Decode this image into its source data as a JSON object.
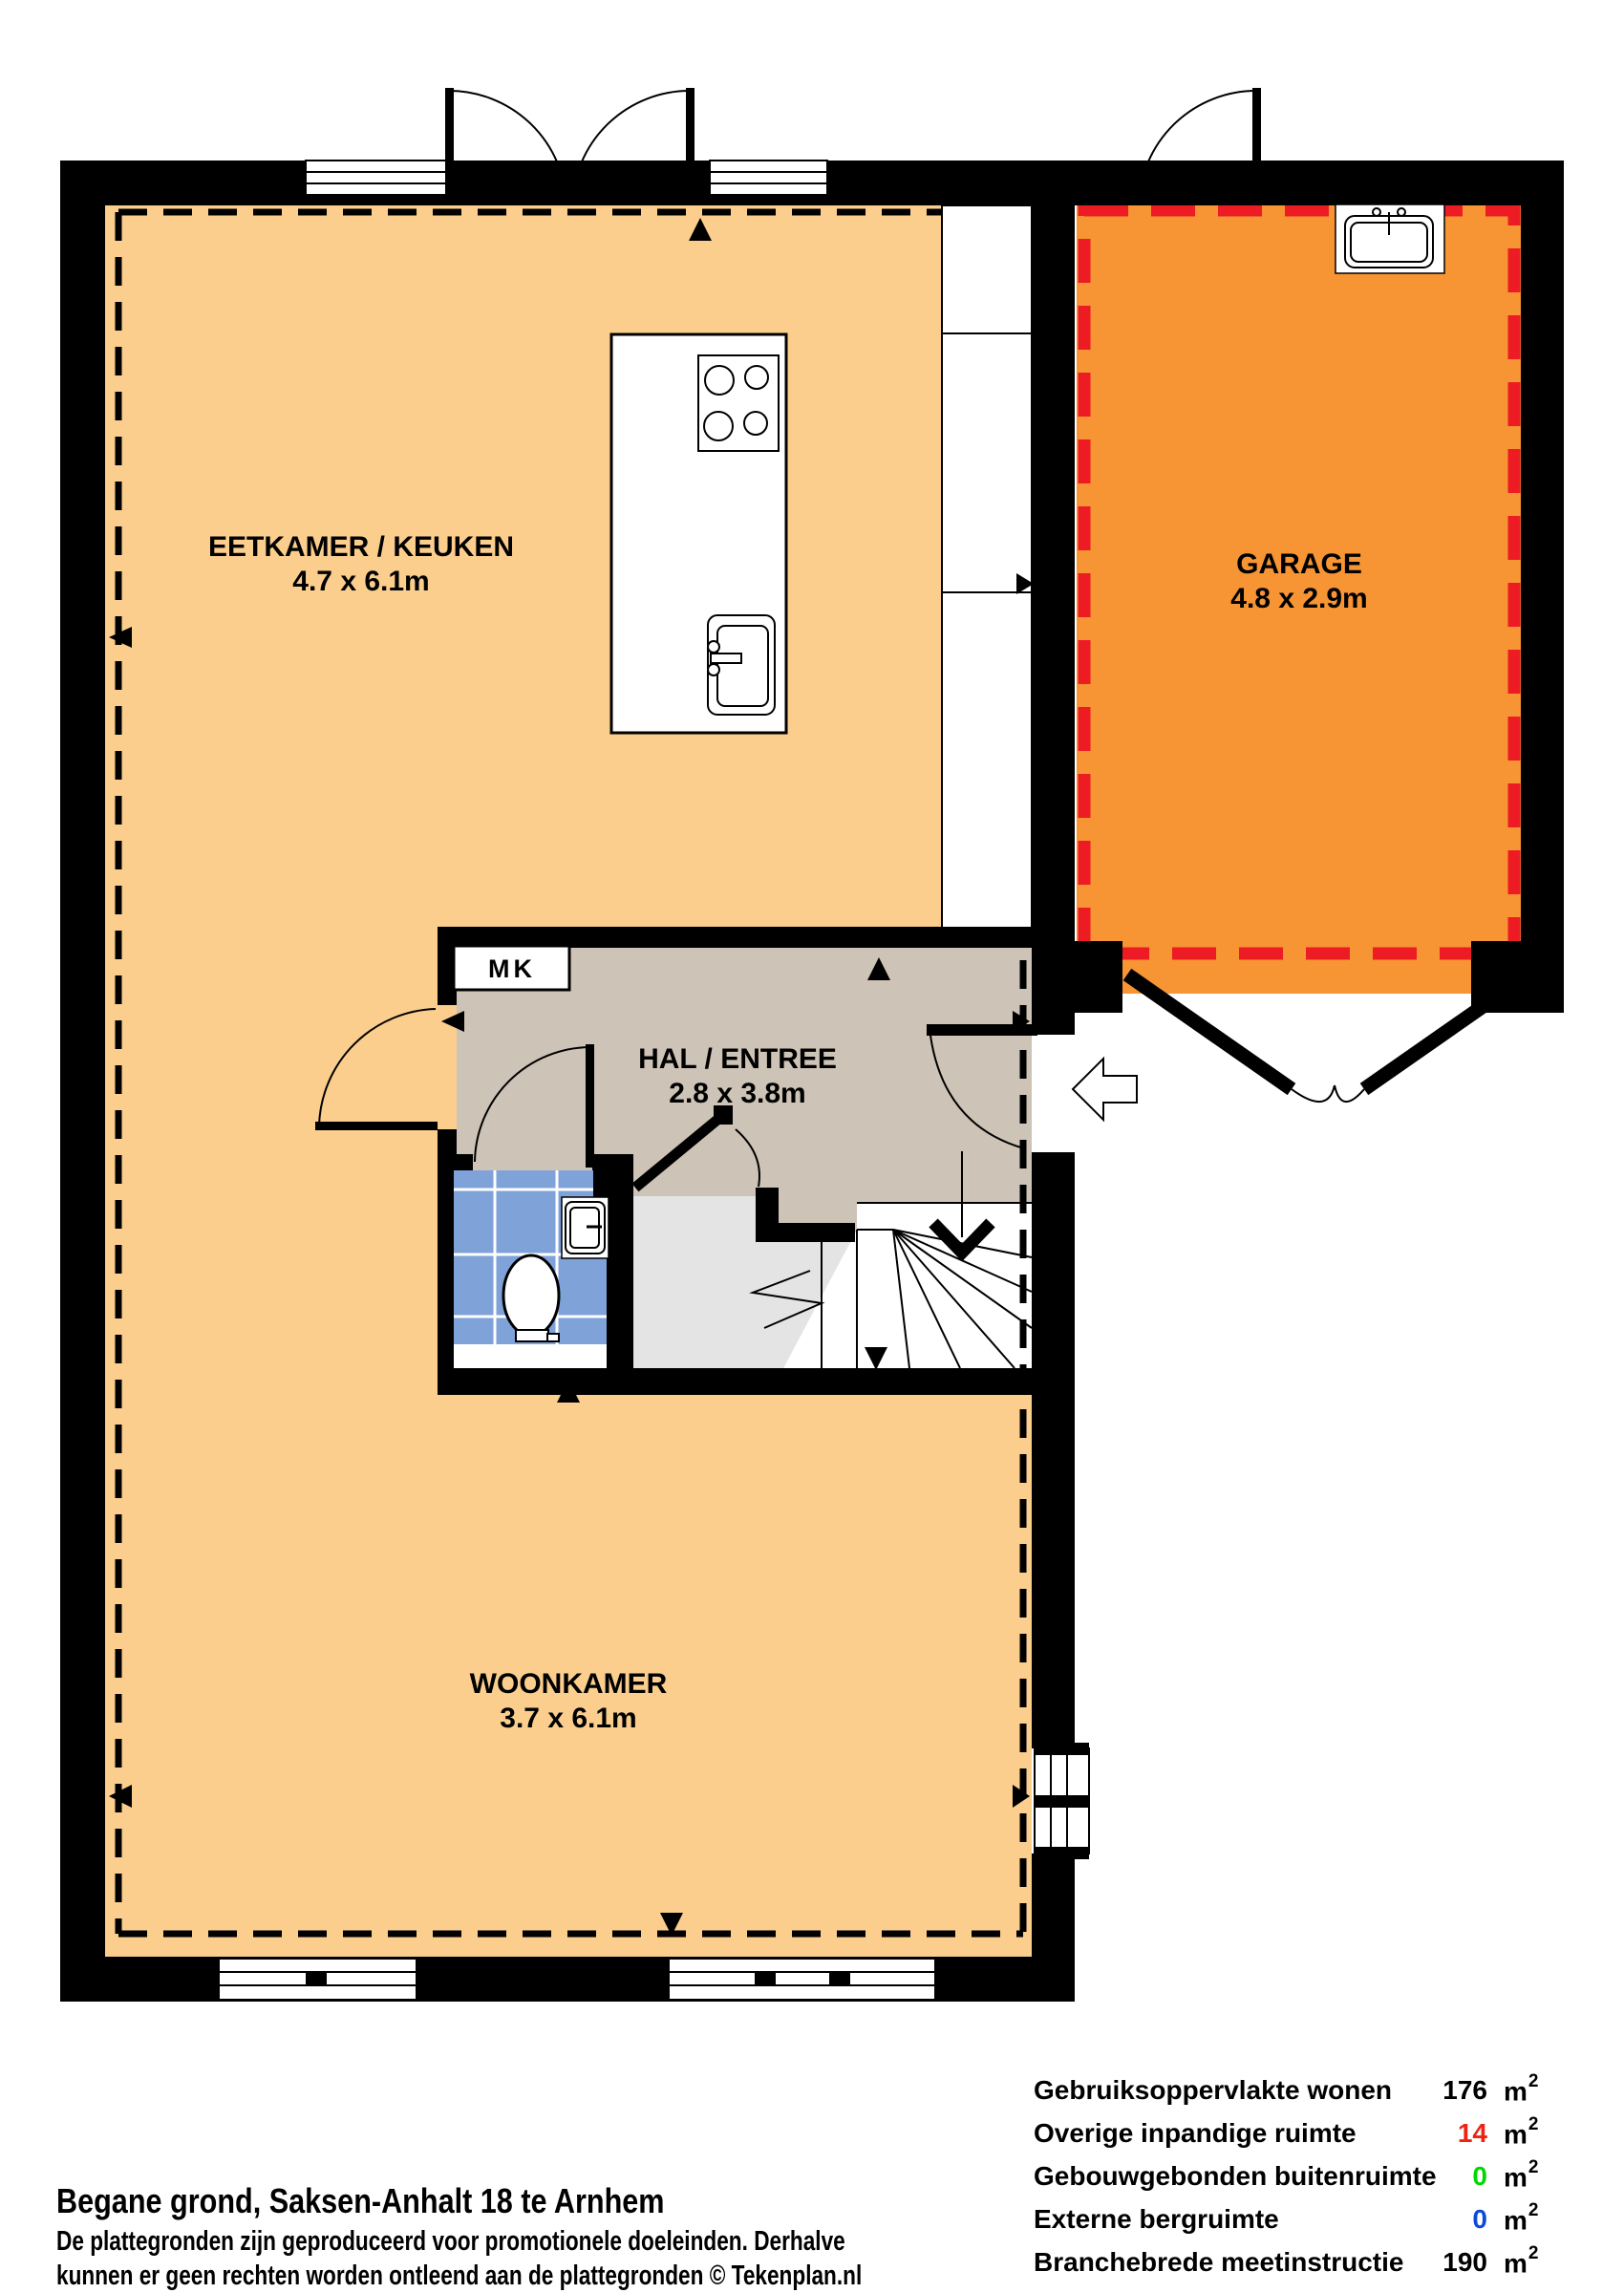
{
  "plan": {
    "rooms": [
      {
        "id": "eetkamer-keuken",
        "label": "EETKAMER / KEUKEN",
        "dims": "4.7 x 6.1m"
      },
      {
        "id": "garage",
        "label": "GARAGE",
        "dims": "4.8 x 2.9m"
      },
      {
        "id": "hal-entree",
        "label": "HAL / ENTREE",
        "dims": "2.8 x 3.8m"
      },
      {
        "id": "woonkamer",
        "label": "WOONKAMER",
        "dims": "3.7 x 6.1m"
      }
    ],
    "closet_label": "MK",
    "colors": {
      "living_floor": "#FBCE8D",
      "garage_floor": "#F79433",
      "hall_floor": "#CDC3B6",
      "toilet_tile": "#7FA2D8",
      "stair_landing": "#E4E4E4",
      "wall": "#000000",
      "measure_dash": "#000000",
      "garage_dash_red": "#ED1C24"
    }
  },
  "footer": {
    "title": "Begane grond, Saksen-Anhalt 18 te Arnhem",
    "disclaimer_line1": "De plattegronden zijn geproduceerd voor promotionele doeleinden. Derhalve",
    "disclaimer_line2": "kunnen er geen rechten worden ontleend aan de plattegronden © Tekenplan.nl"
  },
  "area_table": {
    "unit": "m",
    "unit_sup": "2",
    "rows": [
      {
        "label": "Gebruiksoppervlakte wonen",
        "value": "176",
        "value_color": "#000000"
      },
      {
        "label": "Overige inpandige ruimte",
        "value": "14",
        "value_color": "#ED2413"
      },
      {
        "label": "Gebouwgebonden buitenruimte",
        "value": "0",
        "value_color": "#00D900"
      },
      {
        "label": "Externe bergruimte",
        "value": "0",
        "value_color": "#0D49DC"
      },
      {
        "label": "Branchebrede meetinstructie",
        "value": "190",
        "value_color": "#000000"
      }
    ]
  }
}
